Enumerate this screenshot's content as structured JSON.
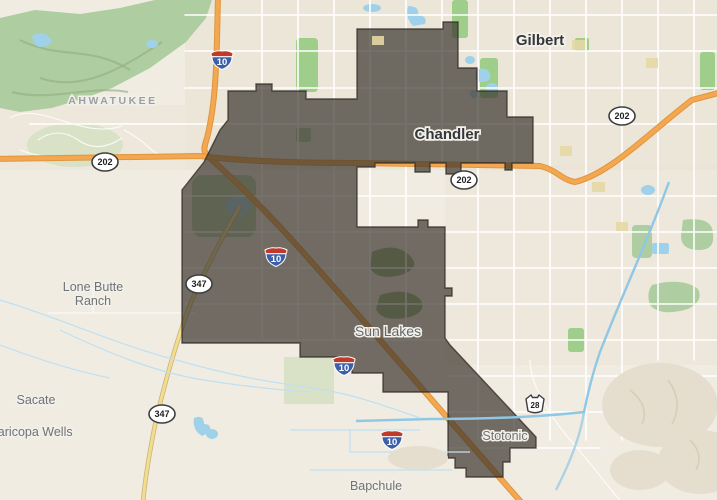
{
  "map": {
    "description": "Street map of the Chandler / Sun Lakes, Arizona area with a dark boundary overlay polygon",
    "place_labels": [
      {
        "key": "gilbert",
        "text": "Gilbert",
        "kind": "city"
      },
      {
        "key": "chandler",
        "text": "Chandler",
        "kind": "city"
      },
      {
        "key": "ahwatukee",
        "text": "AHWATUKEE",
        "kind": "neighborhood"
      },
      {
        "key": "sun_lakes",
        "text": "Sun Lakes",
        "kind": "town"
      },
      {
        "key": "lone_butte_1",
        "text": "Lone Butte",
        "kind": "locality"
      },
      {
        "key": "lone_butte_2",
        "text": "Ranch",
        "kind": "locality"
      },
      {
        "key": "sacate",
        "text": "Sacate",
        "kind": "locality"
      },
      {
        "key": "maricopa_wells",
        "text": "Maricopa Wells",
        "kind": "locality"
      },
      {
        "key": "bapchule",
        "text": "Bapchule",
        "kind": "locality"
      },
      {
        "key": "stotonic",
        "text": "Stotonic",
        "kind": "locality"
      }
    ],
    "shields": {
      "interstate_10": {
        "type": "interstate",
        "number": "10"
      },
      "loop_202": {
        "type": "oval",
        "number": "202"
      },
      "route_347": {
        "type": "oval",
        "number": "347"
      },
      "route_28": {
        "type": "az_state",
        "number": "28"
      }
    },
    "boundary_overlay": {
      "points": "228,91 256,91 256,84 272,84 272,91 306,91 306,99 357,99 357,29 443,29 443,22 458,22 458,68 477,68 477,91 507,91 507,117 533,117 533,163 512,163 512,170 505,170 505,163 461,163 461,174 446,174 446,163 430,163 430,172 415,172 415,163 375,163 375,167 357,167 357,227 418,227 418,220 428,220 428,227 445,227 445,288 452,288 452,296 445,296 445,338 450,345 536,437 536,448 510,448 510,462 503,462 503,477 466,477 466,468 455,468 455,458 448,458 448,392 383,392 383,373 352,373 352,367 336,367 336,357 300,357 300,343 182,343 182,190 204,162 220,130 228,120",
      "fill": "#3A352E",
      "fill_opacity": "0.7",
      "stroke": "#2E2A24"
    },
    "colors": {
      "background": "#F0ECE2",
      "urban_tint": "#EAE1D2",
      "park_green": "#AECDA0",
      "bright_green": "#9FCE8B",
      "pale_green": "#D9E2C6",
      "water_blue": "#9FD2EA",
      "canal_blue": "#8FC8E4",
      "freeway_orange": "#F5A74F",
      "route_yellow": "#F2DC8E",
      "road_white": "#FFFFFF",
      "overlay_dark": "#6C6862",
      "city_label": "#33363B",
      "locality_label": "#6E7376"
    }
  }
}
